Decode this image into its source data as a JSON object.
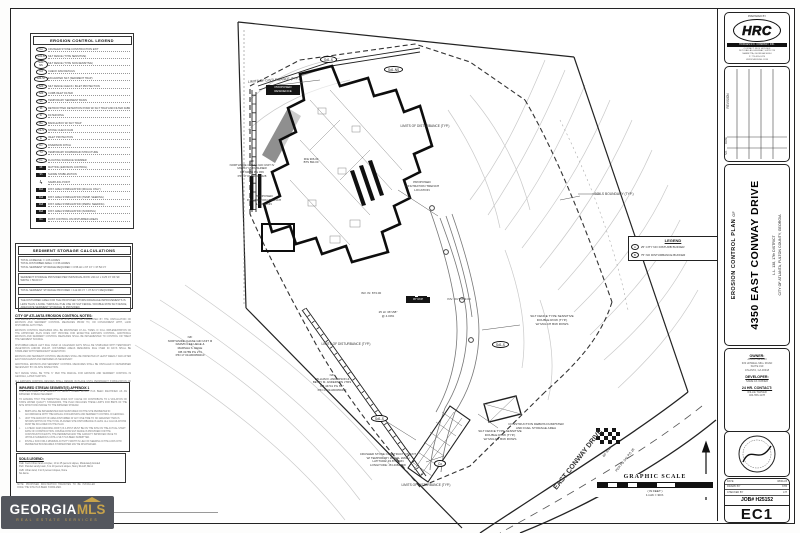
{
  "colors": {
    "accent_gold": "#c7a34b",
    "watermark_bg": "#54575e",
    "line": "#1c1c1c"
  },
  "watermark": {
    "georgia": "GEORGIA",
    "mls": "MLS",
    "tagline": "REAL ESTATE SERVICES"
  },
  "titleblock": {
    "prepared_by": "PREPARED BY",
    "firm_name": "HRC",
    "firm_company": "HODGES R.C. COMPANY, INC.",
    "firm_lines": [
      "CONTACT: RICK HODGES",
      "2470 DALLAS HIGHWAY, SUITE 210",
      "MARIETTA, GEORGIA 30064",
      "P: 770-555-2470",
      "WWW.HRCENG.COM"
    ],
    "revision_label": "REVISION",
    "date_label": "DATE",
    "no_label": "NO.",
    "plan_type": "EROSION CONTROL PLAN",
    "of": "OF",
    "project_title": "4350 EAST CONWAY DRIVE",
    "district": "L.L. 138, 17th DISTRICT",
    "city": "CITY OF ATLANTA, FULTON COUNTY, GEORGIA",
    "owner_label": "OWNER:",
    "owner_lines": [
      "ATBOF DESIGN",
      "333 HOWELL MILL ROAD",
      "SUITE 310",
      "ATLANTA, GA 30318"
    ],
    "developer_label": "DEVELOPER:",
    "developer_lines": [
      "SAME AS OWNER"
    ],
    "contact_label": "24 HR. CONTACT:",
    "contact_lines": [
      "WILLIE TARVER",
      "404-556-1178"
    ],
    "info_rows": [
      [
        "DATE",
        "08/01/23"
      ],
      [
        "DRAWN BY",
        "KTB"
      ],
      [
        "CHECKED BY",
        "JJT"
      ]
    ],
    "job_number": "JOB# H25152",
    "sheet_number": "EC1"
  },
  "legend": {
    "title": "EROSION CONTROL LEGEND",
    "items": [
      {
        "code": "Co",
        "sym": "oval",
        "desc": "CRUSHED STONE CONSTRUCTION EXIT"
      },
      {
        "code": "Sd1-S",
        "sym": "oval",
        "desc": "SILT FENCE (TYPE SENSITIVE)"
      },
      {
        "code": "Sd1-NS",
        "sym": "oval",
        "desc": "SILT FENCE (TYPE NON-SENSITIVE)"
      },
      {
        "code": "Cd",
        "sym": "oval",
        "desc": "CHECK DAM DETAILS"
      },
      {
        "code": "Sd2-ST",
        "sym": "oval",
        "desc": "EXCAVATED SILT (SEDIMENT TRAP)"
      },
      {
        "code": "Sd3",
        "sym": "oval",
        "desc": "SILT FENCE CHECK / INLET PROTECTION"
      },
      {
        "code": "Sd4",
        "sym": "oval",
        "desc": "CURB INLET FILTER"
      },
      {
        "code": "Sb",
        "sym": "oval",
        "desc": "TEMPORARY SEDIMENT BASIN"
      },
      {
        "code": "Rt",
        "sym": "oval",
        "desc": "RETROFITTED DETENTION POND W/ SILT TRAP AND FILTER FABRIC"
      },
      {
        "code": "Fr",
        "sym": "oval",
        "desc": "FILTER RING"
      },
      {
        "code": "Ba",
        "sym": "oval",
        "desc": "BAFFLE BOX W/ SILT TRAP"
      },
      {
        "code": "Ck-S",
        "sym": "oval",
        "desc": "STONE CHECK DAM"
      },
      {
        "code": "Ip",
        "sym": "oval",
        "desc": "INLET PROTECTION"
      },
      {
        "code": "Dv",
        "sym": "oval",
        "desc": "DIVERSION DITCH"
      },
      {
        "code": "Td",
        "sym": "oval",
        "desc": "TEMPORARY DOWNDRAIN STRUCTURE"
      },
      {
        "code": "Fs",
        "sym": "oval",
        "desc": "FLOATING SURFACE SKIMMER"
      },
      {
        "code": "Mt",
        "sym": "sq",
        "desc": "MATTING (EROSION CONTROL)"
      },
      {
        "code": "Sh",
        "sym": "sq",
        "desc": "SHORE STABILIZATION"
      },
      {
        "code": "ϟ",
        "sym": "bolt",
        "desc": "SAMPLING POINT"
      },
      {
        "code": "Ds1",
        "sym": "sq",
        "desc": "DIST. AREA STABILIZATION (MULCH ONLY)"
      },
      {
        "code": "Ds2",
        "sym": "sq",
        "desc": "DIST. AREA STABILIZATION (TEMP. SEEDING)"
      },
      {
        "code": "Ds3",
        "sym": "sq",
        "desc": "DIST. AREA STABILIZATION (PERM. SEEDING)"
      },
      {
        "code": "Ds4",
        "sym": "sq",
        "desc": "DIST. AREA STABILIZATION (SODDING)"
      },
      {
        "code": "Du",
        "sym": "sq",
        "desc": "DUST CONTROL ON DISTURBED AREAS"
      }
    ]
  },
  "sediment": {
    "title": "SEDIMENT STORAGE CALCULATIONS",
    "boxes": [
      [
        "TOTAL ACREAGE:  ± 1.06 ACRES",
        "TOTAL DISTURBED AREA:  ± 0.56 ACRES",
        "TOTAL SEDIMENT STORAGE REQUIRED = 0.56 AC x 67 CY = 37.52 CY"
      ],
      [
        "SEDIMENT STORAGE PROVIDED PER INDIVIDUAL ROW: 224 LF x 0.25 CY OF SF WIDTH = 56.00 CY"
      ],
      [
        "TOTAL SEDIMENT STORAGE PROVIDED = 112.00 CY > 37.52 CY REQUIRED"
      ],
      [
        "THE DISTURBED AREA FOR THE PROPOSED STORM DRAINAGE IMPROVEMENTS IS LESS THAN 1 ACRE. THROUGH THE USE OF SILT FENCE / DOUBLE ROW SILT FENCE, ADEQUATE SEDIMENT STORAGE IS PROVIDED."
      ]
    ]
  },
  "atl_notes": {
    "title": "CITY OF ATLANTA EROSION CONTROL NOTES:",
    "paragraphs": [
      "THE ESCAPE OF SEDIMENT FROM THE SITE SHALL BE PREVENTED BY THE INSTALLATION OF EROSION AND SEDIMENT CONTROL MEASURES PRIOR TO, OR CONCURRENT WITH, LAND DISTURBING ACTIVITIES.",
      "EROSION CONTROL MEASURES WILL BE MAINTAINED AT ALL TIMES. IF FULL IMPLEMENTATION OF THE APPROVED PLAN DOES NOT PROVIDE FOR EFFECTIVE EROSION CONTROL, ADDITIONAL EROSION AND SEDIMENT CONTROL MEASURES SHALL BE IMPLEMENTED TO CONTROL OR TREAT THE SEDIMENT SOURCE.",
      "DISTURBED AREAS LEFT IDLE OVER 14 CALENDAR DAYS SHALL BE STABILIZED WITH TEMPORARY VEGETATION AND/OR MULCH. DISTURBED AREAS REMAINING IDLE OVER 30 DAYS SHALL BE STABILIZED WITH PERMANENT VEGETATION.",
      "EROSION AND SEDIMENT CONTROL MEASURES SHALL BE INSPECTED AT LEAST WEEKLY AND AFTER EACH RAIN EVENT AND REPAIRED AS NECESSARY.",
      "ADDITIONAL EROSION AND SEDIMENT CONTROL MEASURES SHALL BE INSTALLED IF DETERMINED NECESSARY BY ON-SITE INSPECTION.",
      "SILT FENCE SHALL BE TYPE 'C' PER THE MANUAL FOR EROSION AND SEDIMENT CONTROL IN GEORGIA, LATEST EDITION.",
      "ALL EROSION CONTROL DEVICES SHALL REMAIN IN PLACE UNTIL PERMANENT STABILIZATION OF THE SITE HAS BEEN ACHIEVED."
    ]
  },
  "impaired": {
    "title": "IMPAIRED STREAM SEGMENT(S) APPENDIX 1",
    "intro": [
      "THE PROPOSED SITE DRAINS TO NANCY CREEK WHICH HAS BEEN IDENTIFIED AS AN IMPAIRED STREAM SEGMENT.",
      "TO ENSURE THAT THE PERMITTEE DOES NOT CAUSE OR CONTRIBUTE TO A VIOLATION OF STATE WATER QUALITY STANDARDS, THE PLAN INCLUDES THESE LIMITS FOR BMPS OF THE SITE WHICH DISCHARGE TO THE IMPAIRED STREAM:"
    ],
    "items": [
      {
        "ltr": "a.",
        "text": "BMPS WILL BE IMPLEMENTED AND MAINTAINED ON THE SITE PERIMETER IN ACCORDANCE WITH THE MANUAL FOR EROSION AND SEDIMENT CONTROL IN GEORGIA."
      },
      {
        "ltr": "b.",
        "text": "UNIT THE AMOUNT OF AREA DISTURBED AT ANY ONE TIME TO NO GREATER THAN IS SHOWN WITHIN OF THE TOTAL PLANNED SITE DISTURBANCE IS LESS. ALL CALCULATIONS MUST BE INCLUDED ON THE PLAN."
      },
      {
        "ltr": "c.",
        "text": "A CHECK DAM (DRAINING FIRST) IS A POST MUST BE ON THE SITE ON THE ACTUAL START DATE OF CONSTRUCTION. DOUBLE ROW SILT FENCE IS PROVIDED FOR THE CONSTRUCTION EXITS; THE PERIMETER AND THE CAPACITY IMPROVED ONCE TO UPHOLD NUMEROUS UNTIL A SILT HAS BEEN SUBMITTED."
      },
      {
        "ltr": "d.",
        "text": "INSTALL SOD FOR A MINIMUM ACTIVITY WIDTH IN LIEU OF SEEDING IN THE LODS INTO PERIMETER BOUNDARIES STORMWATER MAY BE DISCHARGED."
      }
    ]
  },
  "soils": {
    "title": "SOILS LEGEND:",
    "lines": [
      "CuE:  Cecil-Urban land complex, 10 to 25 percent slopes, Moderately Eroded",
      "PaC:  Pacolet sandy loam, 6 to 10 percent slopes, Stony Runoff, Minor",
      "UuB:  Urban land, 0 to 6 percent slopes, None",
      "No dams."
    ]
  },
  "trench_note": "NOTE: PROPOSED INFILTRATION TRENCHES TO BE INSTALLED ONCE THE SITE HAS BEEN STABILIZED.",
  "plan": {
    "legend_box": {
      "title": "LEGEND",
      "rows": [
        {
          "code": "A",
          "desc": "25' CITY NO DISTURB BUFFER"
        },
        {
          "code": "B",
          "desc": "75' NO DISTURBANCE BUFFER"
        }
      ]
    },
    "scale": {
      "title": "GRAPHIC SCALE",
      "in_feet": "( IN FEET )",
      "ratio": "1 inch = 30 ft."
    },
    "labels": [
      {
        "t": "LIMITS OF DISTURBANCE (TYP.)",
        "x": 228,
        "y": 78,
        "w": 92,
        "r": -4,
        "s": 3.4
      },
      {
        "t": "LIMITS OF DISTURBANCE (TYP.)",
        "x": 392,
        "y": 124,
        "w": 66,
        "s": 3.2
      },
      {
        "t": "PROPOSED\nINFILTRATION TRENCH\nLOCATION",
        "x": 398,
        "y": 181,
        "w": 48,
        "s": 3.1
      },
      {
        "t": "PROPOSED\nINFILTRATION TRENCH\nLOCATION",
        "x": 243,
        "y": 195,
        "w": 42,
        "s": 3.1
      },
      {
        "t": "SOILS BOUNDARY (TYP.)",
        "x": 578,
        "y": 192,
        "w": 72,
        "s": 3.3
      },
      {
        "t": "INV. IN: 873.00",
        "x": 350,
        "y": 292,
        "w": 42,
        "s": 3
      },
      {
        "t": "INV. OUT: 873.00",
        "x": 436,
        "y": 298,
        "w": 46,
        "s": 3
      },
      {
        "t": "25 LF 36\"x58\"\n@ 4.00%",
        "x": 370,
        "y": 311,
        "w": 36,
        "s": 3
      },
      {
        "t": "LIMITS OF DISTURBANCE (TYP.)",
        "x": 310,
        "y": 342,
        "w": 72,
        "s": 3.2
      },
      {
        "t": "SILT FENCE TYPE SENSITIVE\nDOUBLE ROW (TYP.)\nW/ MULCH B/W ROWS",
        "x": 520,
        "y": 315,
        "w": 64,
        "s": 3.1
      },
      {
        "t": "SILT FENCE TYPE SENSITIVE\nDOUBLE ROW (TYP.)\nW/ MULCH B/W ROWS",
        "x": 468,
        "y": 430,
        "w": 64,
        "s": 3.1
      },
      {
        "t": "CONSTRUCTION DEBRIS DUMPSTER\nAND FUEL STORAGE AREA",
        "x": 498,
        "y": 423,
        "w": 76,
        "s": 3.1
      },
      {
        "t": "CRUSHED STONE CONSTRUCTION EXIT\nW/ TEMPORARY WHEEL WASH\nLATITUDE:  33.873793N\nLONGITUDE:  -84.408236W",
        "x": 350,
        "y": 453,
        "w": 76,
        "s": 2.9
      },
      {
        "t": "LIMITS OF DISTURBANCE (TYP.)",
        "x": 388,
        "y": 483,
        "w": 76,
        "s": 3.2
      },
      {
        "t": "EAST CONWAY DRIVE",
        "x": 533,
        "y": 456,
        "w": 92,
        "r": -52,
        "s": 7,
        "cls": "bold"
      },
      {
        "t": "60' R/W",
        "x": 592,
        "y": 450,
        "w": 30,
        "r": -52,
        "s": 3.3
      },
      {
        "t": "PER PB 341 PG 26",
        "x": 600,
        "y": 458,
        "w": 50,
        "r": -52,
        "s": 3.3
      },
      {
        "t": "N/F\nNORTHSIDE CHASE GID UNIT IV\nMARCY M. KUSHNER\nDB 60085 PG 459\nPIN 17 011300050228",
        "x": 220,
        "y": 160,
        "w": 64,
        "s": 2.9
      },
      {
        "t": "N/F\nNORTHSIDE CHASE GID UNIT III\nDARVIN LEE HEGE &\nMARSHA S. HEGE\nDB 31789 PG 274\nPIN 17 011300050210",
        "x": 156,
        "y": 336,
        "w": 68,
        "s": 2.9
      },
      {
        "t": "N/F\nWILLIAM F. ANDERSON &\nBETTY M. ANDERSON JTRS\nDB 44741 PG 697\nPIN 17 011300050412",
        "x": 298,
        "y": 374,
        "w": 68,
        "s": 2.9
      },
      {
        "t": "FFE 906.00\nBTS 894.00",
        "x": 296,
        "y": 158,
        "w": 30,
        "s": 2.8
      },
      {
        "t": "PROPOSED\nRESIDENCE",
        "x": 266,
        "y": 85,
        "w": 30,
        "s": 3,
        "cls": "blackbox"
      },
      {
        "t": "36\" RCP",
        "x": 406,
        "y": 297,
        "w": 20,
        "s": 2.7,
        "cls": "blackbox"
      },
      {
        "t": "Sd1-S",
        "x": 492,
        "y": 341,
        "cls": "oval"
      },
      {
        "t": "Sd1-S",
        "x": 371,
        "y": 415,
        "cls": "oval"
      },
      {
        "t": "Co",
        "x": 434,
        "y": 460,
        "cls": "oval"
      },
      {
        "t": "Sd1-S",
        "x": 320,
        "y": 56,
        "cls": "oval"
      },
      {
        "t": "Sd1-NS",
        "x": 384,
        "y": 66,
        "cls": "oval"
      }
    ]
  }
}
